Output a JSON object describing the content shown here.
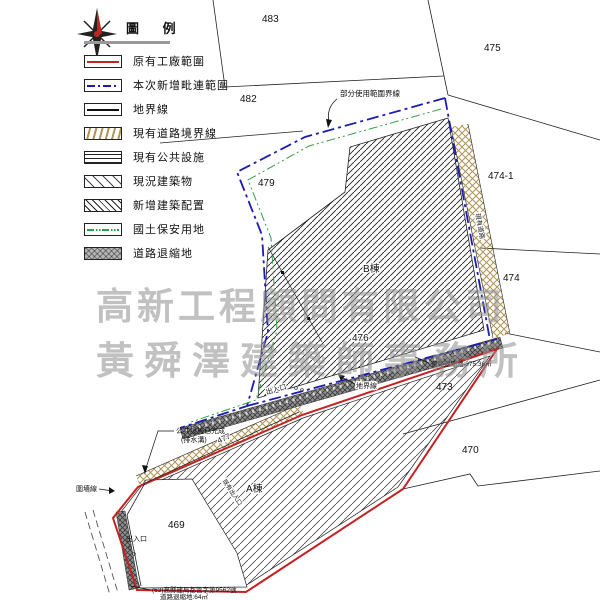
{
  "legend": {
    "title": "圖 例",
    "items": [
      {
        "label": "原有工廠範圍",
        "symbol": "red-solid-line"
      },
      {
        "label": "本次新增毗連範圍",
        "symbol": "blue-dashdot-line"
      },
      {
        "label": "地界線",
        "symbol": "black-solid-line"
      },
      {
        "label": "現有道路境界線",
        "symbol": "tan-road-hatch"
      },
      {
        "label": "現有公共設施",
        "symbol": "horizontal-lines"
      },
      {
        "label": "現況建築物",
        "symbol": "sparse-diagonal-hatch"
      },
      {
        "label": "新增建築配置",
        "symbol": "dense-diagonal-hatch"
      },
      {
        "label": "國土保安用地",
        "symbol": "green-dashdot-line"
      },
      {
        "label": "道路退縮地",
        "symbol": "gray-crosshatch-fill"
      }
    ]
  },
  "watermark": {
    "line1": "高新工程顧問有限公司",
    "line2": "黃舜澤建築師事務所"
  },
  "parcels": {
    "p483": "483",
    "p475": "475",
    "p482": "482",
    "p479": "479",
    "p474_1": "474-1",
    "p474": "474",
    "p476": "476",
    "p473": "473",
    "p470": "470",
    "p469": "469",
    "p477": "477"
  },
  "buildings": {
    "b": "B棟",
    "a": "A棟"
  },
  "labels": {
    "partial_use": "部分使用範圍界線",
    "road_retreat_b": "道路退縮地:375.36㎡",
    "boundary_line": "地界線",
    "pubfac_done": "公共設施已完成",
    "pubfac_done2": "(排水溝)",
    "wall_line": "圍墻線",
    "entrance1": "出入口",
    "entrance2": "出入口",
    "old_entrance": "既有出入口",
    "existing_road": "現有道路",
    "permit": "(63)高縣建局都管字第9562號",
    "road_retreat_a": "道路退縮地:64㎡"
  },
  "colors": {
    "factory_red": "#c52222",
    "new_area_blue": "#1c1cb0",
    "conservation_green": "#2f9e44",
    "road_tan": "#b09355",
    "retreat_gray": "#909090"
  }
}
